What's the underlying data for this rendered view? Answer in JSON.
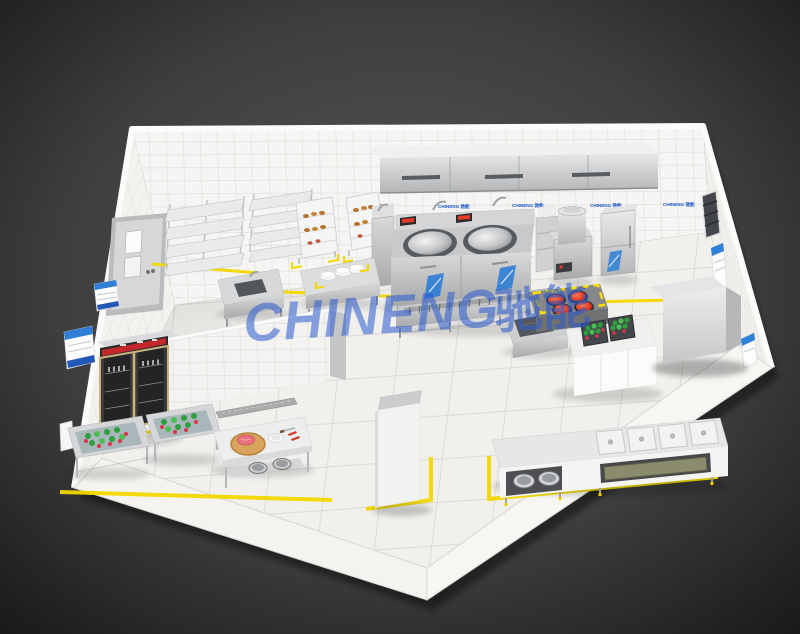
{
  "brand": {
    "watermark_latin": "CHINENG",
    "watermark_cn": "驰能",
    "wall_label": "CHINENG 驰能"
  },
  "colors": {
    "background_dark": "#2e2e2e",
    "floor": "#f1f0ed",
    "wall_tile": "#f6f5f3",
    "marking_yellow": "#f2d800",
    "watermark_blue": "#2b5bd0",
    "label_blue": "#1e56c8",
    "poster_blue": "#2f7fd6",
    "burner_red": "#d8301c",
    "vegetable_green": "#2f9e3f",
    "vegetable_red": "#d8344a",
    "stainless_steel": "#c9cacc",
    "fridge_sign_red": "#c4272c",
    "cutting_board_wood": "#d8a35c"
  }
}
